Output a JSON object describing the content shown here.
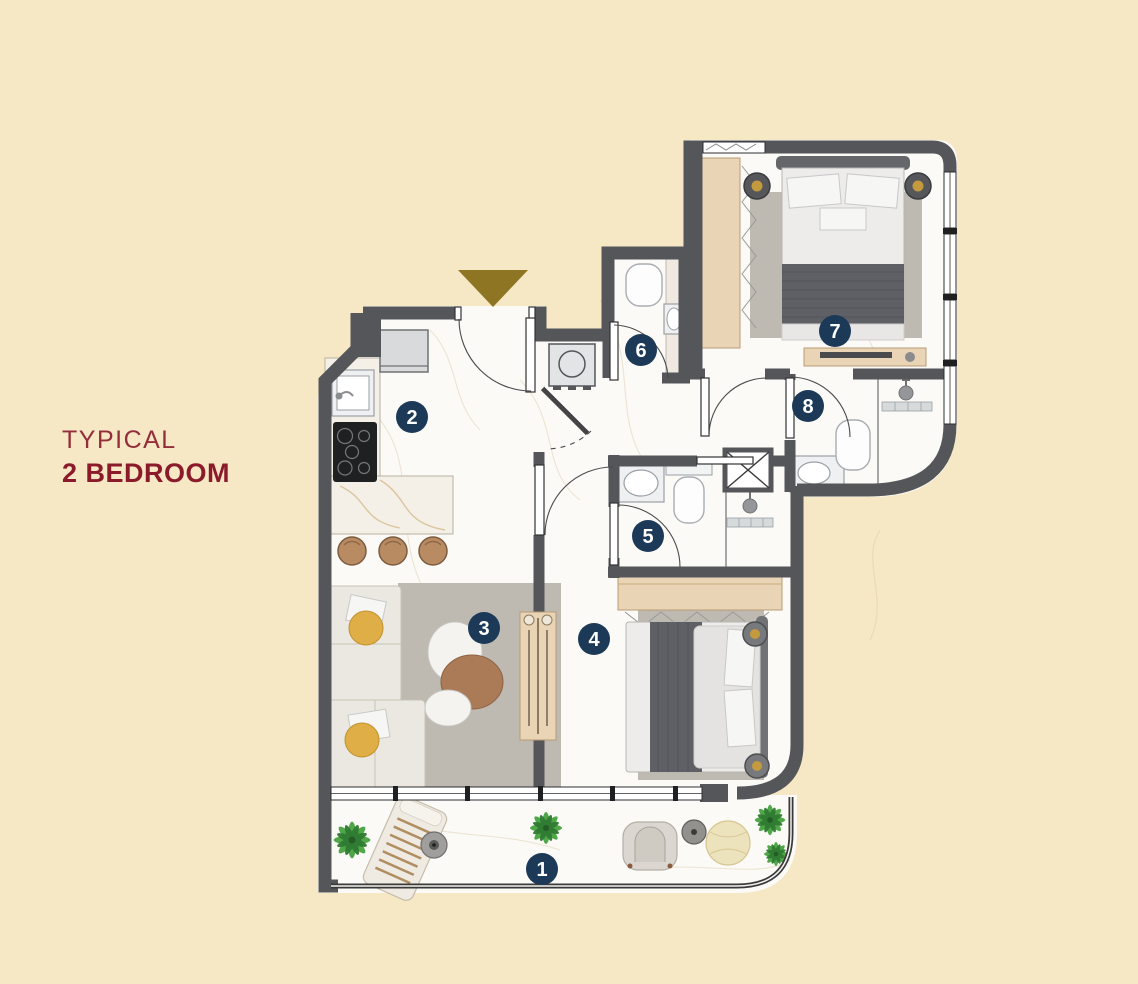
{
  "page": {
    "background_color": "#f6e7c5"
  },
  "title": {
    "line1": "TYPICAL",
    "line2": "2 BEDROOM"
  },
  "colors": {
    "bg": "#f6e7c5",
    "wall": "#55565a",
    "marker": "#1c3a57",
    "marker_text": "#ffffff",
    "maroon_light": "#932e3a",
    "maroon_bold": "#8b1b2b",
    "gold": "#8d7523",
    "wood": "#e9d4b5",
    "floor": "#fbfaf7",
    "rug": "#beb9b1",
    "green": "#3e8f3c"
  },
  "plan": {
    "markers": [
      {
        "label": "1",
        "x": 542,
        "y": 869
      },
      {
        "label": "2",
        "x": 412,
        "y": 417
      },
      {
        "label": "3",
        "x": 484,
        "y": 628
      },
      {
        "label": "4",
        "x": 594,
        "y": 639
      },
      {
        "label": "5",
        "x": 648,
        "y": 536
      },
      {
        "label": "6",
        "x": 641,
        "y": 350
      },
      {
        "label": "7",
        "x": 835,
        "y": 331
      },
      {
        "label": "8",
        "x": 808,
        "y": 406
      }
    ],
    "entry_symbol": "entrance-triangle"
  }
}
